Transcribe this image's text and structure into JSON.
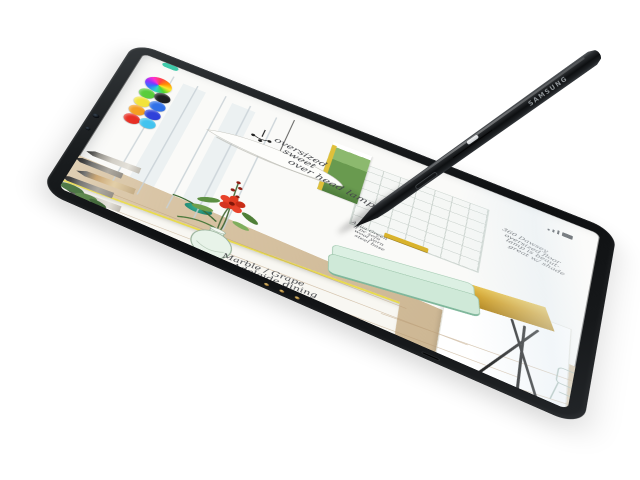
{
  "stylus": {
    "brand_label": "SAMSUNG"
  },
  "app": {
    "selected_color_swatch": "#3ec9a9",
    "rainbow_picker_stops": [
      "#ff4040",
      "#ff8f00",
      "#ffe928",
      "#4fd42e",
      "#28d6c8",
      "#2e6cff",
      "#8a2bff",
      "#ff2bd0",
      "#ff4040"
    ],
    "palette": [
      {
        "name": "green",
        "hex": "#54cb36"
      },
      {
        "name": "black",
        "hex": "#1c1c1e"
      },
      {
        "name": "yellow",
        "hex": "#f2e234"
      },
      {
        "name": "blue",
        "hex": "#2e6fe8"
      },
      {
        "name": "orange",
        "hex": "#f59b1a"
      },
      {
        "name": "indigo",
        "hex": "#2c3ed9"
      },
      {
        "name": "red",
        "hex": "#e7271c"
      },
      {
        "name": "cyan",
        "hex": "#3fc2ef"
      }
    ],
    "tools": [
      "graphite-pencil",
      "charcoal-stick",
      "sketch-pencil",
      "marker",
      "brush-pen"
    ],
    "status_icons": [
      "signal",
      "wifi",
      "battery"
    ]
  },
  "sketch": {
    "annotations": [
      {
        "id": "overhead-lamp",
        "lines": [
          "oversized",
          "sweet",
          "over head lamp !"
        ]
      },
      {
        "id": "dining-table",
        "lines": [
          "Marble / Grape",
          "Adelaide dining"
        ]
      },
      {
        "id": "sofa",
        "lines": [
          "Aqua Green",
          "8 pc sofa",
          "wool yarn",
          "steel base"
        ]
      },
      {
        "id": "floor-lamp",
        "lines": [
          "360 Dawsey",
          "oversized floor",
          "lamp is beaut-",
          "great w/ shade"
        ]
      }
    ],
    "colors": {
      "sofa_mint": "#cfe9d8",
      "lamp_gold": "#d1a129",
      "table_edge_yellow": "#e4d54a",
      "floor_wood": "#d8c5a6",
      "flower_red": "#e23c22",
      "cabinet_green": "#76a258",
      "dish_teal": "#2fa08a"
    }
  }
}
